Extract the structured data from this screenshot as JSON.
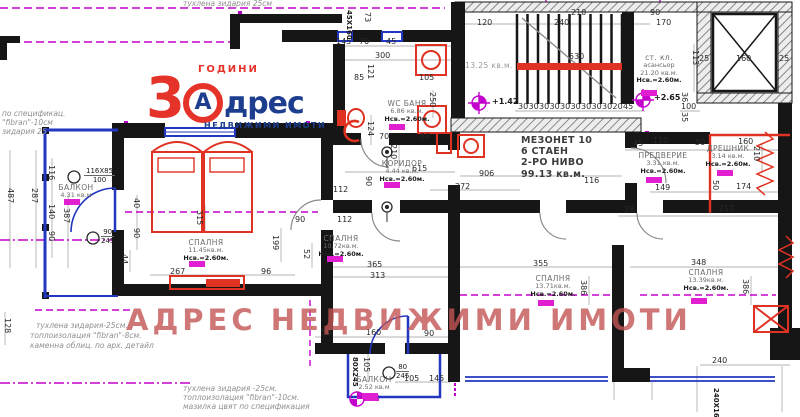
{
  "logo": {
    "top": "ГОДИНИ",
    "years": "3",
    "ring_letter": "А",
    "brand_rest": "дрес",
    "tagline": "НЕДВИЖИМИ ИМОТИ"
  },
  "watermark": {
    "text": "АДРЕС НЕДВИЖИМИ ИМОТИ"
  },
  "unit": {
    "x": 521,
    "y": 135,
    "lines": [
      "МЕЗОНЕТ 10",
      "6 СТАЕН",
      "2-РО НИВО",
      "99.13 кв.м."
    ]
  },
  "rooms": [
    {
      "x": 76,
      "y": 184,
      "lines": [
        "БАЛКОН",
        "4.31 кв.м"
      ],
      "tag": [
        64,
        199
      ]
    },
    {
      "x": 206,
      "y": 239,
      "lines": [
        "СПАЛНЯ",
        "11.45кв.м.",
        "Нсв.=2.60м."
      ],
      "tag": [
        189,
        261
      ]
    },
    {
      "x": 407,
      "y": 100,
      "lines": [
        "WC БАНЯ",
        "6.86 кв.м.",
        "Нсв.=2.60м."
      ],
      "tag": [
        389,
        124
      ]
    },
    {
      "x": 402,
      "y": 160,
      "lines": [
        "КОРИДОР",
        "4.44 кв.м.",
        "Нсв.=2.60м."
      ],
      "tag": [
        384,
        182
      ]
    },
    {
      "x": 659,
      "y": 54,
      "lines": [
        "ст. кл.",
        "асансьор",
        "21.20 кв.м.",
        "Нсв.=2.60м."
      ],
      "tag": [
        641,
        90
      ]
    },
    {
      "x": 663,
      "y": 152,
      "lines": [
        "ПРЕДВЕРИЕ",
        "3.31 кв.м.",
        "Нсв.=2.60м."
      ],
      "tag": [
        646,
        177
      ]
    },
    {
      "x": 728,
      "y": 145,
      "lines": [
        "ДРЕШНИК",
        "3.14 кв.м.",
        "Нсв.=2.60м."
      ],
      "tag": [
        717,
        170
      ]
    },
    {
      "x": 341,
      "y": 235,
      "lines": [
        "СПАЛНЯ",
        "10.72кв.м.",
        "Нсв.=2.60м."
      ],
      "tag": [
        327,
        256
      ]
    },
    {
      "x": 553,
      "y": 275,
      "lines": [
        "СПАЛНЯ",
        "13.71кв.м.",
        "Нсв.=2.60м."
      ],
      "tag": [
        538,
        300
      ]
    },
    {
      "x": 706,
      "y": 269,
      "lines": [
        "СПАЛНЯ",
        "13.39кв.м.",
        "Нсв.=2.60м."
      ],
      "tag": [
        691,
        298
      ]
    },
    {
      "x": 374,
      "y": 376,
      "lines": [
        "БАЛКОН",
        "2.52 кв.м"
      ],
      "tag": [
        362,
        393
      ]
    },
    {
      "x": 489,
      "y": 62,
      "faint": true,
      "lines": [
        "13.25 кв.м."
      ]
    }
  ],
  "stairs": {
    "x": 518,
    "y": 103,
    "step": 10.5,
    "treads": [
      "30",
      "30",
      "30",
      "30",
      "30",
      "30",
      "30",
      "30",
      "30",
      "20",
      "45"
    ]
  },
  "dimensions": [
    {
      "t": "120",
      "x": 477,
      "y": 19
    },
    {
      "t": "240",
      "x": 554,
      "y": 19
    },
    {
      "t": "210",
      "x": 571,
      "y": 9
    },
    {
      "t": "90",
      "x": 650,
      "y": 9
    },
    {
      "t": "170",
      "x": 656,
      "y": 19
    },
    {
      "t": "530",
      "x": 569,
      "y": 53
    },
    {
      "t": "100",
      "x": 681,
      "y": 103
    },
    {
      "t": "25",
      "x": 699,
      "y": 55
    },
    {
      "t": "160",
      "x": 736,
      "y": 55
    },
    {
      "t": "25",
      "x": 779,
      "y": 55
    },
    {
      "t": "113",
      "x": 699,
      "y": 50,
      "r": 90
    },
    {
      "t": "36",
      "x": 688,
      "y": 92,
      "r": 90
    },
    {
      "t": "35",
      "x": 688,
      "y": 112,
      "r": 90
    },
    {
      "t": "145",
      "x": 336,
      "y": 38
    },
    {
      "t": "70",
      "x": 359,
      "y": 38
    },
    {
      "t": "45",
      "x": 386,
      "y": 38
    },
    {
      "t": "300",
      "x": 375,
      "y": 52
    },
    {
      "t": "85",
      "x": 354,
      "y": 74
    },
    {
      "t": "121",
      "x": 374,
      "y": 64,
      "r": 90
    },
    {
      "t": "105",
      "x": 419,
      "y": 74
    },
    {
      "t": "250",
      "x": 436,
      "y": 92,
      "r": 90
    },
    {
      "t": "124",
      "x": 374,
      "y": 121,
      "r": 90
    },
    {
      "t": "73",
      "x": 371,
      "y": 12,
      "r": 90
    },
    {
      "t": "70",
      "x": 379,
      "y": 133
    },
    {
      "t": "88",
      "x": 420,
      "y": 133
    },
    {
      "t": "615",
      "x": 412,
      "y": 165
    },
    {
      "t": "906",
      "x": 479,
      "y": 170
    },
    {
      "t": "272",
      "x": 455,
      "y": 183
    },
    {
      "t": "210",
      "x": 397,
      "y": 144,
      "r": 90
    },
    {
      "t": "112",
      "x": 333,
      "y": 186
    },
    {
      "t": "90",
      "x": 372,
      "y": 176,
      "r": 90
    },
    {
      "t": "116",
      "x": 584,
      "y": 177
    },
    {
      "t": "45",
      "x": 633,
      "y": 140
    },
    {
      "t": "110",
      "x": 653,
      "y": 137
    },
    {
      "t": "50",
      "x": 695,
      "y": 139
    },
    {
      "t": "160",
      "x": 738,
      "y": 138
    },
    {
      "t": "210",
      "x": 760,
      "y": 146,
      "r": 90
    },
    {
      "t": "149",
      "x": 655,
      "y": 184
    },
    {
      "t": "50",
      "x": 719,
      "y": 180,
      "r": 90
    },
    {
      "t": "174",
      "x": 736,
      "y": 183
    },
    {
      "t": "28",
      "x": 624,
      "y": 206
    },
    {
      "t": "217",
      "x": 719,
      "y": 205
    },
    {
      "t": "487",
      "x": 14,
      "y": 188,
      "r": 90
    },
    {
      "t": "287",
      "x": 38,
      "y": 188,
      "r": 90
    },
    {
      "t": "387",
      "x": 70,
      "y": 208,
      "r": 90
    },
    {
      "t": "116",
      "x": 55,
      "y": 165,
      "r": 90
    },
    {
      "t": "140",
      "x": 55,
      "y": 204,
      "r": 90
    },
    {
      "t": "90",
      "x": 55,
      "y": 231,
      "r": 90
    },
    {
      "t": "128",
      "x": 11,
      "y": 318,
      "r": 90
    },
    {
      "t": "40",
      "x": 140,
      "y": 198,
      "r": 90
    },
    {
      "t": "90",
      "x": 140,
      "y": 228,
      "r": 90
    },
    {
      "t": "44",
      "x": 128,
      "y": 254,
      "r": 90
    },
    {
      "t": "315",
      "x": 203,
      "y": 210,
      "r": 90
    },
    {
      "t": "199",
      "x": 279,
      "y": 235,
      "r": 90
    },
    {
      "t": "267",
      "x": 170,
      "y": 268
    },
    {
      "t": "96",
      "x": 261,
      "y": 268
    },
    {
      "t": "112",
      "x": 337,
      "y": 216
    },
    {
      "t": "90",
      "x": 295,
      "y": 216
    },
    {
      "t": "52",
      "x": 310,
      "y": 249,
      "r": 90
    },
    {
      "t": "365",
      "x": 367,
      "y": 261
    },
    {
      "t": "313",
      "x": 370,
      "y": 272
    },
    {
      "t": "355",
      "x": 533,
      "y": 260
    },
    {
      "t": "386",
      "x": 587,
      "y": 280,
      "r": 90
    },
    {
      "t": "348",
      "x": 691,
      "y": 259
    },
    {
      "t": "386",
      "x": 749,
      "y": 279,
      "r": 90
    },
    {
      "t": "240",
      "x": 712,
      "y": 357
    },
    {
      "t": "50",
      "x": 321,
      "y": 329
    },
    {
      "t": "160",
      "x": 366,
      "y": 329
    },
    {
      "t": "90",
      "x": 424,
      "y": 330
    },
    {
      "t": "105",
      "x": 370,
      "y": 357,
      "r": 90
    },
    {
      "t": "105",
      "x": 404,
      "y": 375
    },
    {
      "t": "145",
      "x": 429,
      "y": 375
    }
  ],
  "levels": [
    {
      "t": "+1.42",
      "x": 492,
      "y": 97
    },
    {
      "t": "+2.65",
      "x": 654,
      "y": 93
    }
  ],
  "window_tags": [
    {
      "t": "45X160",
      "x": 352,
      "y": 10,
      "r": 90
    },
    {
      "t": "80X245",
      "x": 358,
      "y": 357,
      "r": 90
    },
    {
      "t": "240X160",
      "x": 719,
      "y": 388,
      "r": 90
    }
  ],
  "circle_tags": [
    {
      "top": "116X85",
      "bot": "100",
      "x": 84,
      "y": 167
    },
    {
      "top": "90",
      "bot": "245",
      "x": 101,
      "y": 228
    },
    {
      "top": "80",
      "bot": "245",
      "x": 396,
      "y": 363
    }
  ],
  "notes": [
    {
      "t": "тухлена зидария 25см",
      "x": 183,
      "y": 0
    },
    {
      "t": "по спецификац.",
      "x": 2,
      "y": 110
    },
    {
      "t": "\"fibran\"-10см",
      "x": 2,
      "y": 119
    },
    {
      "t": "зидария 25",
      "x": 2,
      "y": 128
    },
    {
      "t": "тухлена зидария-25см.",
      "x": 36,
      "y": 322
    },
    {
      "t": "топлоизолация \"fibran\"-8см.",
      "x": 30,
      "y": 332
    },
    {
      "t": "каменна облиц. по арх. детайл",
      "x": 30,
      "y": 342
    },
    {
      "t": "тухлена зидария -25см.",
      "x": 183,
      "y": 385
    },
    {
      "t": "топлоизолация \"fibran\"-10см.",
      "x": 183,
      "y": 394
    },
    {
      "t": "мазилка цвят по спецификация",
      "x": 183,
      "y": 403
    }
  ],
  "colors": {
    "wall": "#161616",
    "window_blue": "#2336c0",
    "furniture_red": "#e03222",
    "dimension_magenta": "#c400cc",
    "tag_magenta": "#e020d0",
    "note_gray": "#8f8f8f",
    "logo_red": "#e6332a",
    "logo_blue": "#1d3d8f",
    "watermark": "#c35555"
  }
}
